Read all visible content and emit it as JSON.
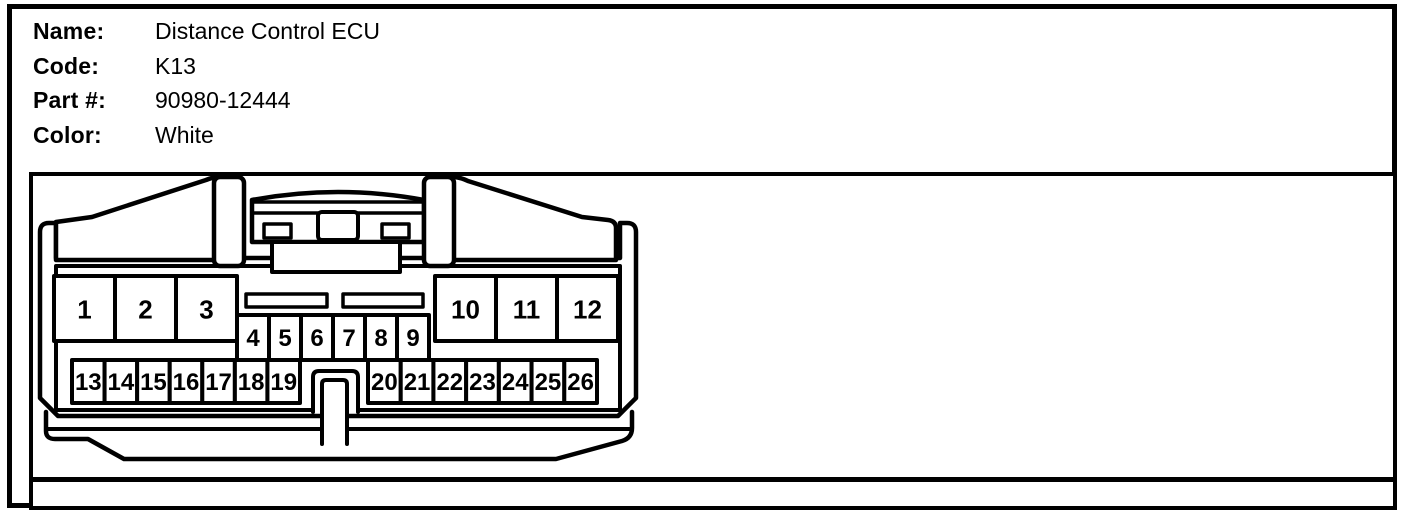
{
  "header": {
    "fields": [
      {
        "label": "Name:",
        "value": "Distance Control ECU"
      },
      {
        "label": "Code:",
        "value": "K13"
      },
      {
        "label": "Part #:",
        "value": "90980-12444"
      },
      {
        "label": "Color:",
        "value": "White"
      }
    ]
  },
  "connector": {
    "description": "26-pin ECU connector face view",
    "pin_rows": [
      {
        "name": "row1-left",
        "pins": [
          "1",
          "2",
          "3"
        ]
      },
      {
        "name": "row1-middle",
        "pins": [
          "4",
          "5",
          "6",
          "7",
          "8",
          "9"
        ]
      },
      {
        "name": "row1-right",
        "pins": [
          "10",
          "11",
          "12"
        ]
      },
      {
        "name": "row2-left",
        "pins": [
          "13",
          "14",
          "15",
          "16",
          "17",
          "18",
          "19"
        ]
      },
      {
        "name": "row2-right",
        "pins": [
          "20",
          "21",
          "22",
          "23",
          "24",
          "25",
          "26"
        ]
      }
    ],
    "colors": {
      "line": "#000000",
      "background": "#ffffff"
    }
  }
}
